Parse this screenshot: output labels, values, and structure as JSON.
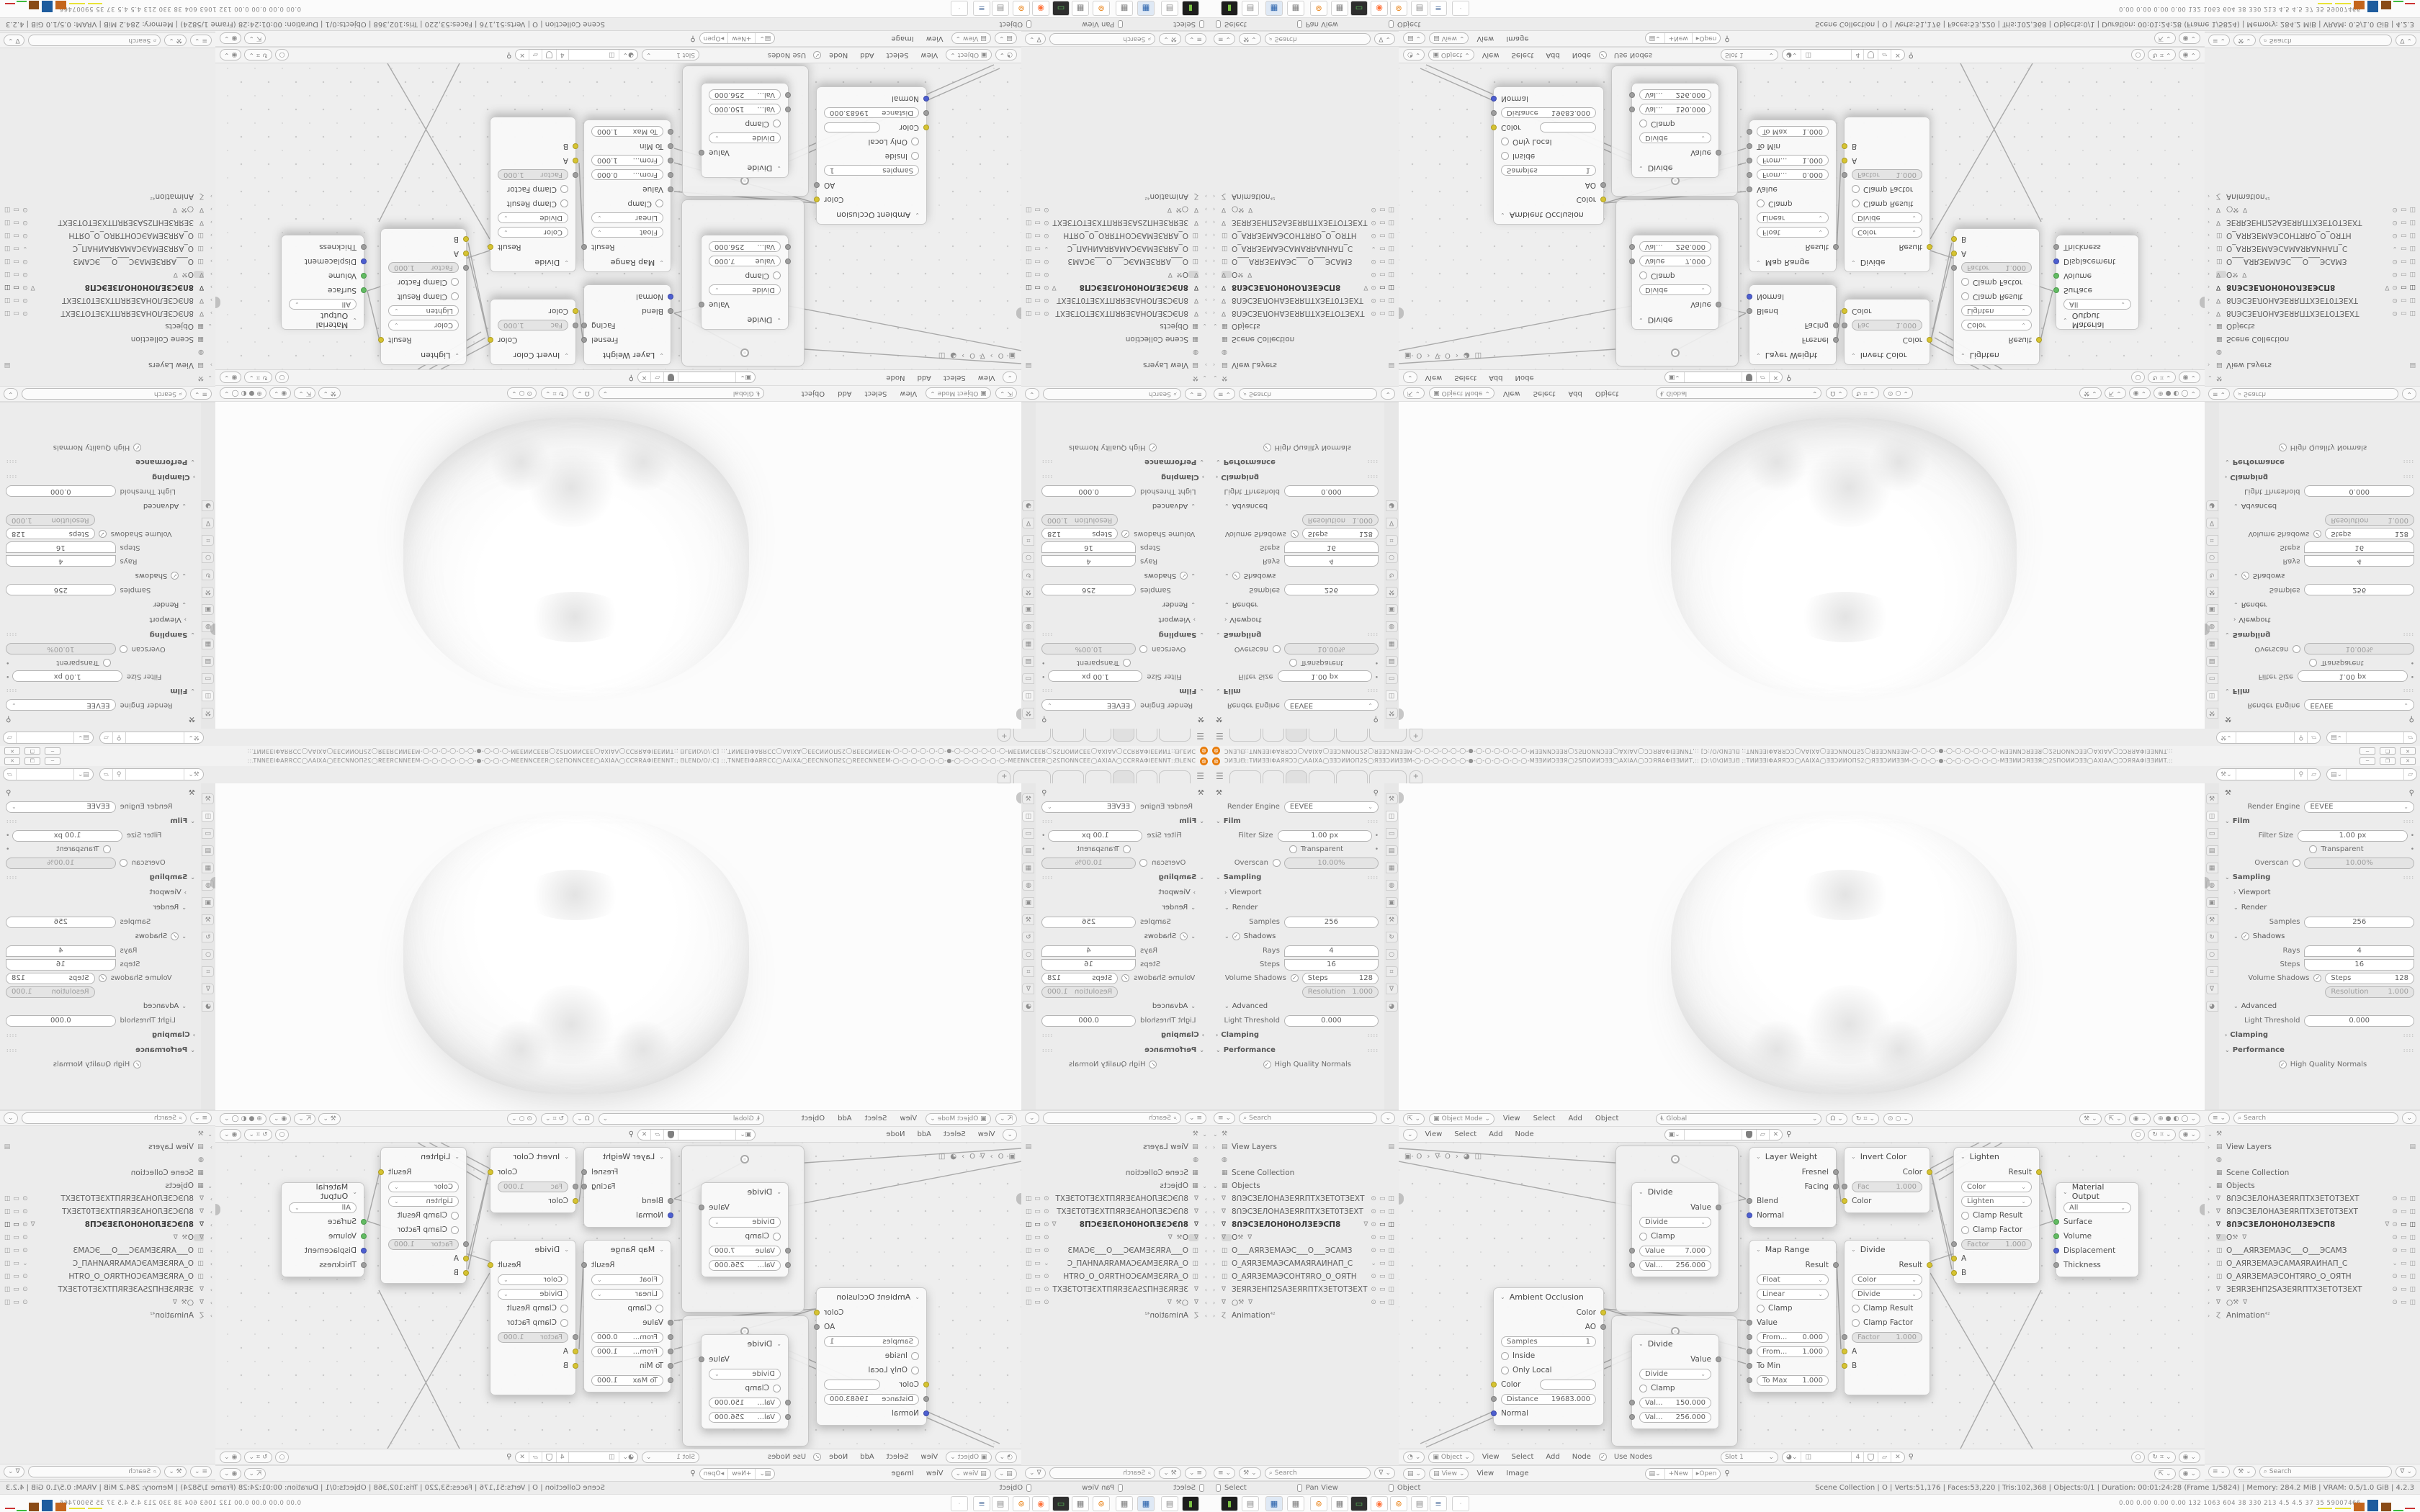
{
  "window": {
    "title": "ƆͶƎ⅃ᗺ::TͶͶƎƎIΦAЯЯƆƆ◯ΛAIXA◯ƎƎƆͶͶOΠ2Ѕ◯ЯƎƎƆͶͶƎƎM-◯-◯-◯-◯-◯-◯-●-◯-◯-◯-◯-◯-◯-MƎƎͶͶƆƎƎЯ◯2ЅΠOͶͶƆƎƎ◯AXIAΛ◯ƆƆЯЯAΦIƎƎͶͶT,:: [Ɔ:\\O\\ᗡͶƎ⅃ᗺ ;:TͶͶƎƎIΦAЯЯƆƆ◯ΛAIXA◯ƎƎƆͶͶOΠЅ2◯ЯƎƎƆͶͶƎƎM-◯-◯-◯-●-◯-◯-◯-◯-◯-◯-MƎƎͶͶƆЯƎƎЯ◯2ЅΠOͶͶƆƎƎ◯AXIAΛ◯ƆƆЯЯAΦIƎƎͶͶT.::",
    "minimize": "─",
    "maximize": "❐",
    "close": "✕",
    "new_tab": "+",
    "hamburger": "☰"
  },
  "icons": {
    "blender": "⊚",
    "search": "⌕",
    "caret": "⌄",
    "chevron": "›",
    "pin": "⚲",
    "copy": "▱",
    "close": "✕",
    "check": "✓",
    "eye": "⊙",
    "monitor": "▭",
    "camera": "◫",
    "mesh": "∇",
    "collection": "▦",
    "world": "◍",
    "image": "▤",
    "funnel": "∇",
    "list": "≡",
    "tool": "⚒",
    "circle": "○",
    "snap": "⌗",
    "overlay": "◉",
    "rotate": "↻",
    "magnet": "Ω",
    "editor3d": "⇱",
    "shading_wire": "⊕",
    "shading_solid": "●",
    "shading_material": "◐",
    "shading_render": "◯",
    "clock": "◔",
    "matball": "◕",
    "square": "▣",
    "folder": "▸",
    "globalaxis": "Ⱡ"
  },
  "properties": {
    "render_engine_label": "Render Engine",
    "render_engine": "EEVEE",
    "film": "Film",
    "filter_size": "Filter Size",
    "filter_size_value": "1.00 px",
    "transparent": "Transparent",
    "overscan": "Overscan",
    "overscan_value": "10.00%",
    "sampling": "Sampling",
    "viewport": "Viewport",
    "render": "Render",
    "samples": "Samples",
    "samples_value": "256",
    "shadows": "Shadows",
    "rays": "Rays",
    "rays_value": "4",
    "steps": "Steps",
    "steps_value": "16",
    "volume_shadows": "Volume Shadows",
    "volume_steps_label": "Steps",
    "volume_steps_value": "128",
    "resolution": "Resolution",
    "resolution_value": "1.000",
    "advanced": "Advanced",
    "light_threshold": "Light Threshold",
    "light_threshold_value": "0.000",
    "clamping": "Clamping",
    "performance": "Performance",
    "high_quality_normals": "High Quality Normals"
  },
  "outliner": {
    "search_placeholder": "Search",
    "view_layers": "View Layers",
    "scene_collection": "Scene Collection",
    "objects": "Objects",
    "animation": "Animation",
    "animation_badge": "⁴²",
    "rows": [
      {
        "name": "8ՈЭСЗЕЛОНАЗЕЯRПТХЗЕТОТЗЕХТ"
      },
      {
        "name": "8ՈЭСЗЕЛОНАЗЕЯRПТХЗЕТ0ТЗЕХТ"
      },
      {
        "name": "8ՈЭСЗЕЛОН0НОЛЗЕЭСП8"
      },
      {
        "name": "O"
      },
      {
        "name": "O___AЯRЗЕМАЭС___O___ЭСАМЗ"
      },
      {
        "name": "O_AЯRЗЕМАЭСАМАЯRАИНАП_С"
      },
      {
        "name": "O_AЯRЗЕМАЭСОНТЯRО_O_ОЯТН"
      },
      {
        "name": "ЗЕЯRЗЕНП2SАЗЕЯRПТХЗЕТОТЗЕХТ"
      },
      {
        "name": "○"
      }
    ]
  },
  "menus": {
    "view": "View",
    "select": "Select",
    "add": "Add",
    "object": "Object",
    "node": "Node",
    "image": "Image"
  },
  "viewport_header": {
    "mode": "Object Mode",
    "orientation": "Global"
  },
  "node_header": {
    "use_nodes": "Use Nodes",
    "slot": "Slot 1",
    "mat_name": "◫",
    "users": "4",
    "breadcrumb_1": "O",
    "breadcrumb_2": "O",
    "breadcrumb_3": "◫"
  },
  "image_header": {
    "mode": "View",
    "new": "New",
    "open": "Open"
  },
  "nodes": {
    "divide1": {
      "title": "Divide",
      "out": "Value",
      "op": "Divide",
      "clamp": "Clamp",
      "f1": "Value",
      "f1v": "7.000",
      "f2": "Val...",
      "f2v": "256.000"
    },
    "divide1b": {
      "title": "Divide",
      "out": "Value",
      "op": "Divide",
      "clamp": "Clamp",
      "f1": "Val...",
      "f1v": "150.000",
      "f2": "Val...",
      "f2v": "256.000"
    },
    "layer_weight": {
      "title": "Layer Weight",
      "out1": "Fresnel",
      "out2": "Facing",
      "in1": "Blend",
      "in2": "Normal"
    },
    "invert": {
      "title": "Invert Color",
      "out": "Color",
      "f1": "Fac",
      "f1v": "1.000",
      "in1": "Color"
    },
    "lighten": {
      "title": "Lighten",
      "out": "Result",
      "sel1": "Color",
      "sel2": "Lighten",
      "chk1": "Clamp Result",
      "chk2": "Clamp Factor",
      "f1": "Factor",
      "f1v": "1.000",
      "inA": "A",
      "inB": "B"
    },
    "map_range": {
      "title": "Map Range",
      "out": "Result",
      "sel1": "Float",
      "sel2": "Linear",
      "chk1": "Clamp",
      "in1": "Value",
      "f1": "From...",
      "f1v": "0.000",
      "f2": "From...",
      "f2v": "1.000",
      "f3": "To Min",
      "f3v": "0.000",
      "f4": "To Max",
      "f4v": "1.000"
    },
    "divide2": {
      "title": "Divide",
      "out": "Result",
      "sel1": "Color",
      "sel2": "Divide",
      "chk1": "Clamp Result",
      "chk2": "Clamp Factor",
      "f1": "Factor",
      "f1v": "1.000",
      "inA": "A",
      "inB": "B"
    },
    "material_output": {
      "title": "Material Output",
      "sel1": "All",
      "in1": "Surface",
      "in2": "Volume",
      "in3": "Displacement",
      "in4": "Thickness"
    },
    "ambient_occlusion": {
      "title": "Ambient Occlusion",
      "out1": "Color",
      "out2": "AO",
      "f1": "Samples",
      "f1v": "1",
      "chk1": "Inside",
      "chk2": "Only Local",
      "in1": "Color",
      "f2": "Distance",
      "f2v": "19683.000",
      "in3": "Normal"
    }
  },
  "status_bar": {
    "hint_select": "Select",
    "hint_pan": "Pan View",
    "hint_object": "Object",
    "stats": "Scene Collection | O | Verts:51,176 | Faces:53,220 | Tris:102,368 | Objects:0/1 | Duration: 00:01:24:28 (Frame 1/5824) | Memory: 284.2 MiB | VRAM: 0.5/1.0 GiB | 4.2.3"
  },
  "taskbar": {
    "numbers": "0.00 0.00 0.00 0.00  132  1063 604   38   330   213   4.5   4.5   37   35  59007466",
    "colors": {
      "orange": "#c4651c",
      "blue": "#1e5c9e",
      "brown": "#8a4b17",
      "yellow": "#e8e337",
      "green": "#3dbb3d",
      "red": "#cc3333",
      "accent": "#e87d0d"
    }
  }
}
